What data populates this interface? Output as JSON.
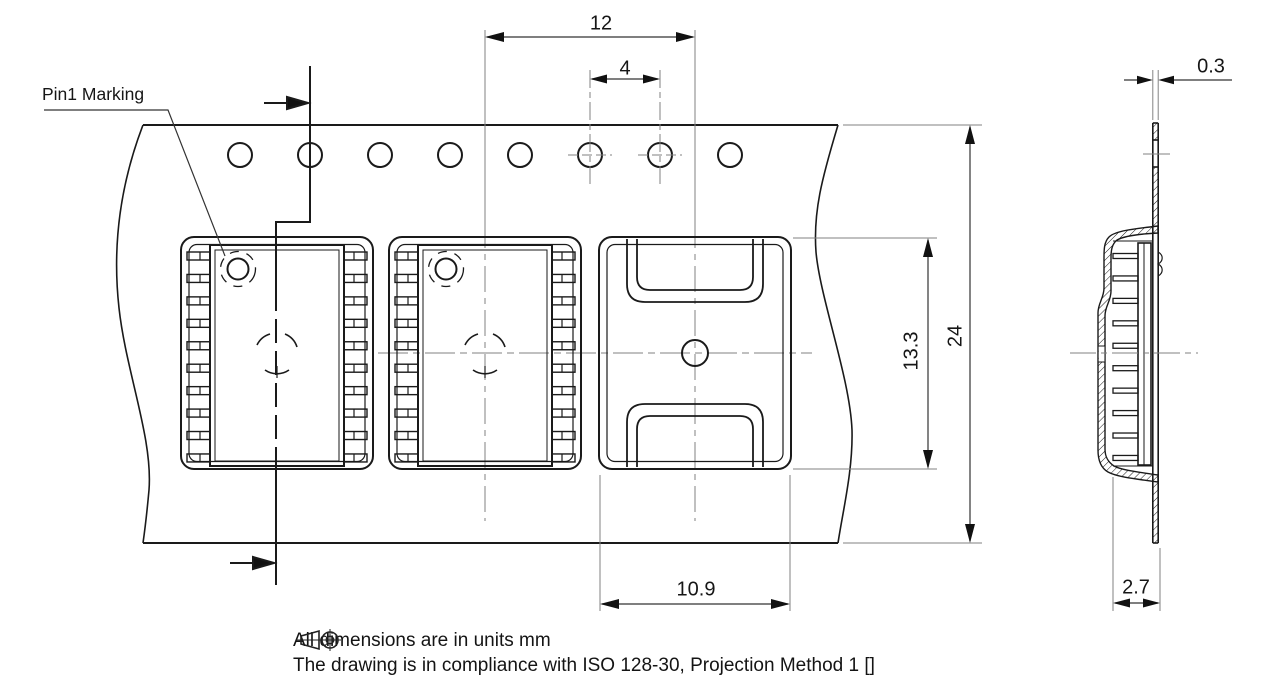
{
  "drawing": {
    "pin1_label": "Pin1 Marking",
    "dimensions": {
      "pocket_pitch": "12",
      "hole_pitch": "4",
      "tape_width": "24",
      "pocket_length": "13.3",
      "pocket_width": "10.9",
      "tape_thickness": "0.3",
      "pocket_depth": "2.7"
    },
    "notes": {
      "units_line": "All dimensions are in units mm",
      "iso_line_prefix": "The drawing is in compliance with ISO 128-30, Projection Method 1 [",
      "iso_line_suffix": "]"
    },
    "icons": {
      "projection_symbol": "first-angle-projection-icon"
    },
    "colors": {
      "line_main": "#1a1a1a",
      "line_thin": "#828282",
      "background": "#ffffff"
    }
  }
}
